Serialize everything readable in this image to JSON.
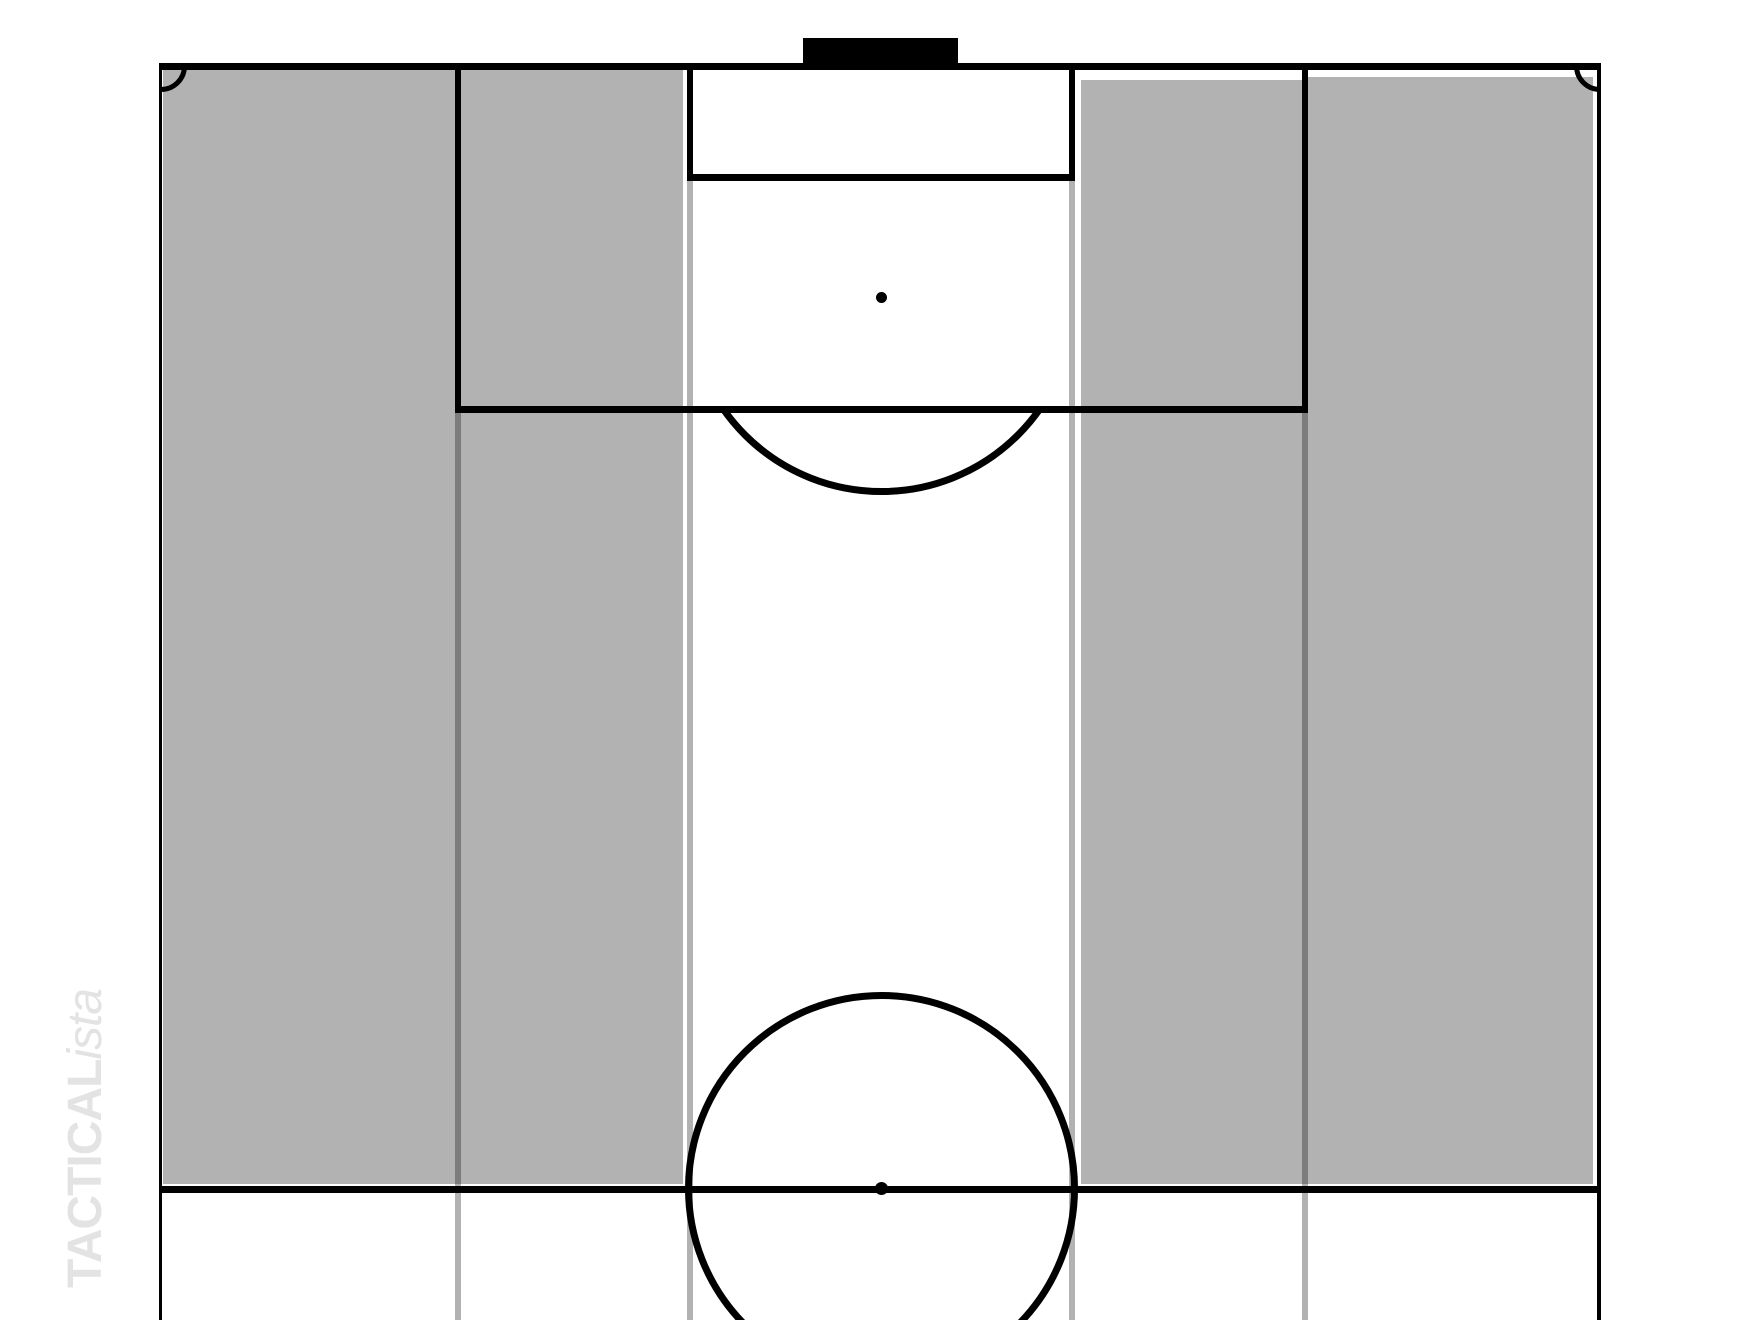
{
  "watermark": {
    "bold": "TACTICAL",
    "italic": "ista"
  },
  "colors": {
    "background": "#ffffff",
    "zone_fill": "#b2b2b2",
    "pitch_line": "#000000",
    "channel_line": "rgba(0,0,0,0.3)",
    "watermark": "#e3e3e3"
  },
  "board": {
    "zones": [
      {
        "name": "shaded-zone-wide-left",
        "x": 163,
        "y": 68,
        "w": 294,
        "h": 1116
      },
      {
        "name": "shaded-zone-half-space-left",
        "x": 457,
        "y": 68,
        "w": 226,
        "h": 1116
      },
      {
        "name": "shaded-zone-half-space-right",
        "x": 1081,
        "y": 80,
        "w": 224,
        "h": 1104
      },
      {
        "name": "shaded-zone-wide-right",
        "x": 1305,
        "y": 77,
        "w": 288,
        "h": 1107
      }
    ],
    "channel_lines": [
      {
        "name": "channel-line-penalty-left",
        "x": 455,
        "y": 407,
        "w": 6,
        "h": 913
      },
      {
        "name": "channel-line-goal-left",
        "x": 687,
        "y": 175,
        "w": 6,
        "h": 1145
      },
      {
        "name": "channel-line-goal-right",
        "x": 1069,
        "y": 175,
        "w": 6,
        "h": 1145
      },
      {
        "name": "channel-line-penalty-right",
        "x": 1302,
        "y": 407,
        "w": 6,
        "h": 913
      }
    ]
  }
}
